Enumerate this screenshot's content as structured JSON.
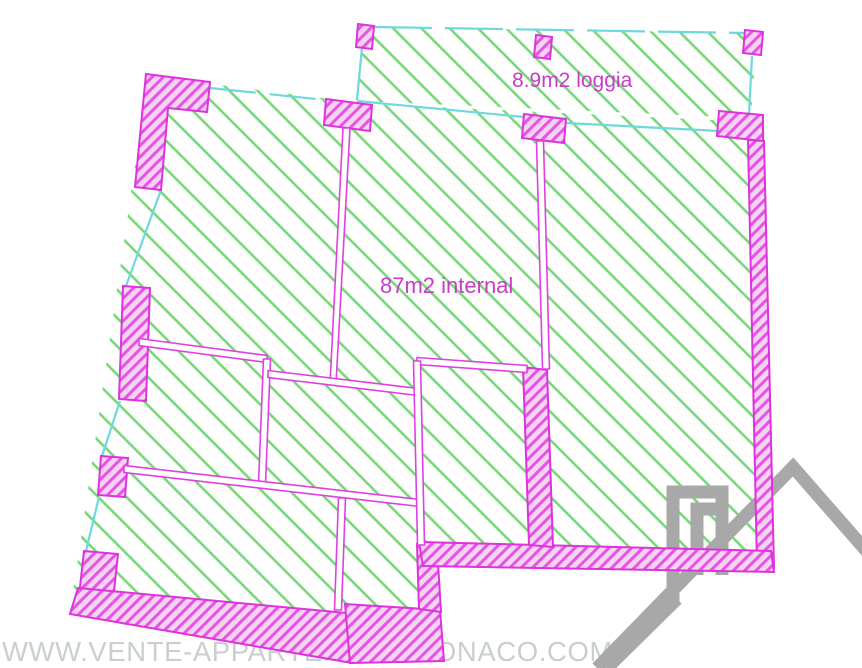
{
  "floor_plan": {
    "type": "apartment-floor-plan",
    "labels": {
      "loggia": "8.9m2 loggia",
      "internal": "87m2 internal"
    },
    "areas": {
      "loggia_m2": "8.9",
      "internal_m2": "87"
    },
    "colors": {
      "wall_magenta": "#de32de",
      "wall_fill_pink": "#f7d3f3",
      "floor_hatch_green": "#76d776",
      "window_cyan": "#6fd8dc",
      "label_magenta": "#c83cc8",
      "watermark_gray": "#c9ced1",
      "logo_gray": "#a8a8a8"
    }
  },
  "watermark": {
    "text": "WWW.VENTE-APPARTEMENT-MONACO.COM"
  }
}
